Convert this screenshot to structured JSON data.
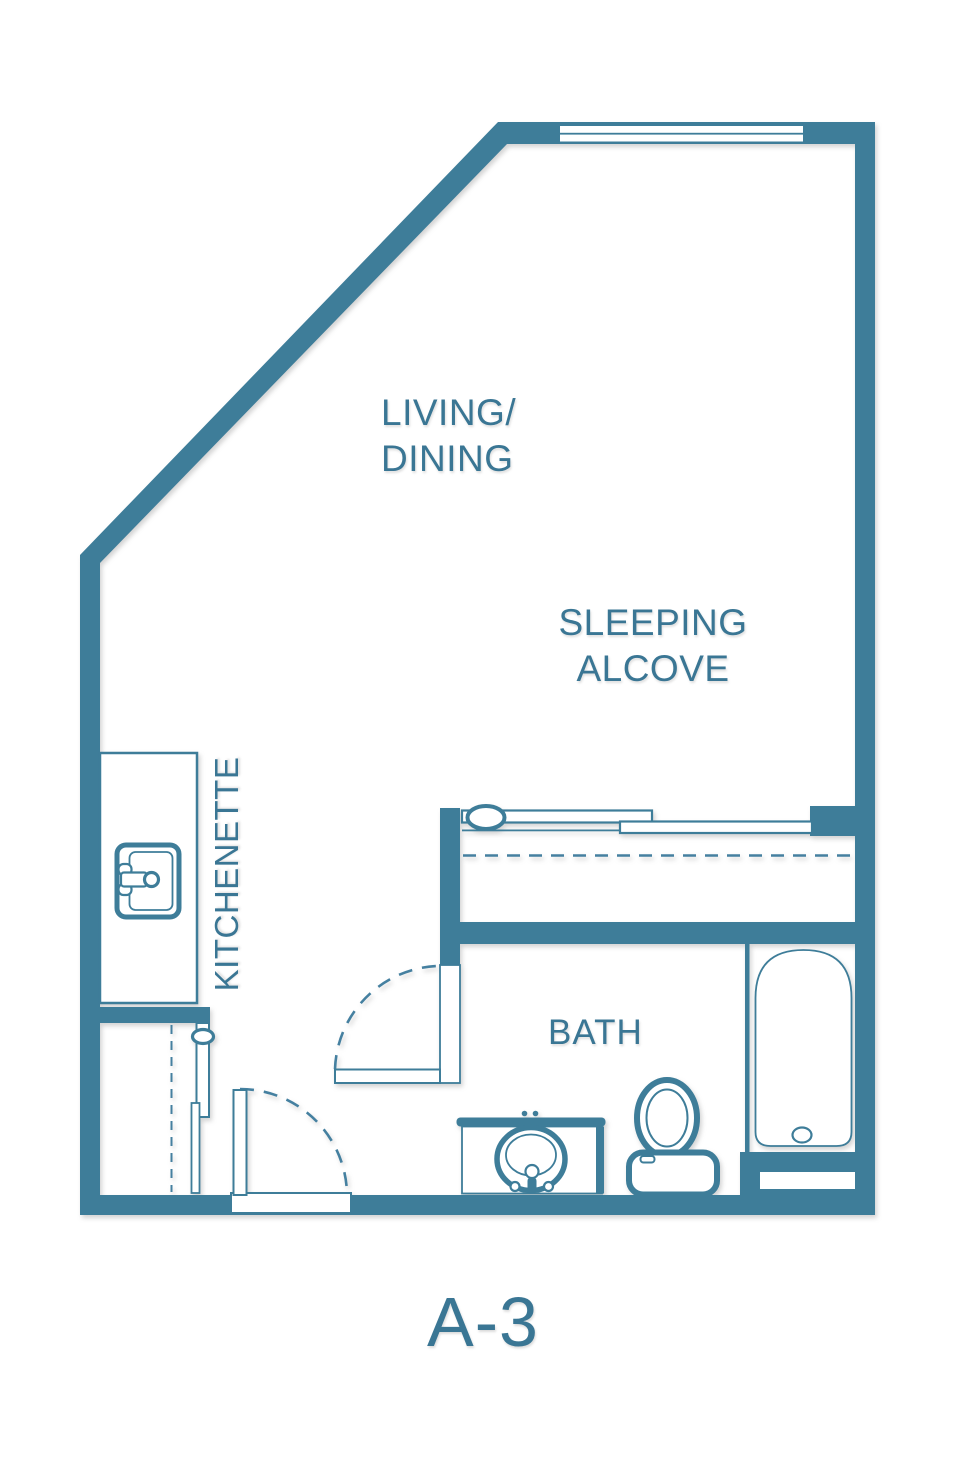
{
  "plan": {
    "name": "A-3",
    "type": "studio-apartment-floor-plan",
    "colors": {
      "background": "#ffffff",
      "wall": "#3e7d99",
      "label": "#3a7694"
    },
    "rooms": {
      "living_dining": "LIVING/\nDINING",
      "sleeping_alcove": "SLEEPING\nALCOVE",
      "kitchenette": "KITCHENETTE",
      "bath": "BATH"
    },
    "fixtures": [
      {
        "name": "window",
        "location": "top-wall"
      },
      {
        "name": "kitchen-sink",
        "location": "kitchenette-counter"
      },
      {
        "name": "wardrobe-sliding-doors",
        "location": "sleeping-alcove-closet"
      },
      {
        "name": "closet-rod-dashed-line",
        "location": "sleeping-alcove-closet"
      },
      {
        "name": "sliding-door",
        "location": "lower-left-closet"
      },
      {
        "name": "closet-rod-dashed-line",
        "location": "lower-left-closet"
      },
      {
        "name": "entry-door-swing",
        "location": "bottom-wall"
      },
      {
        "name": "bath-door-swing",
        "location": "bath-west-wall"
      },
      {
        "name": "vanity-sink",
        "location": "bath"
      },
      {
        "name": "toilet",
        "location": "bath"
      },
      {
        "name": "bathtub",
        "location": "bath-east-alcove"
      }
    ]
  }
}
